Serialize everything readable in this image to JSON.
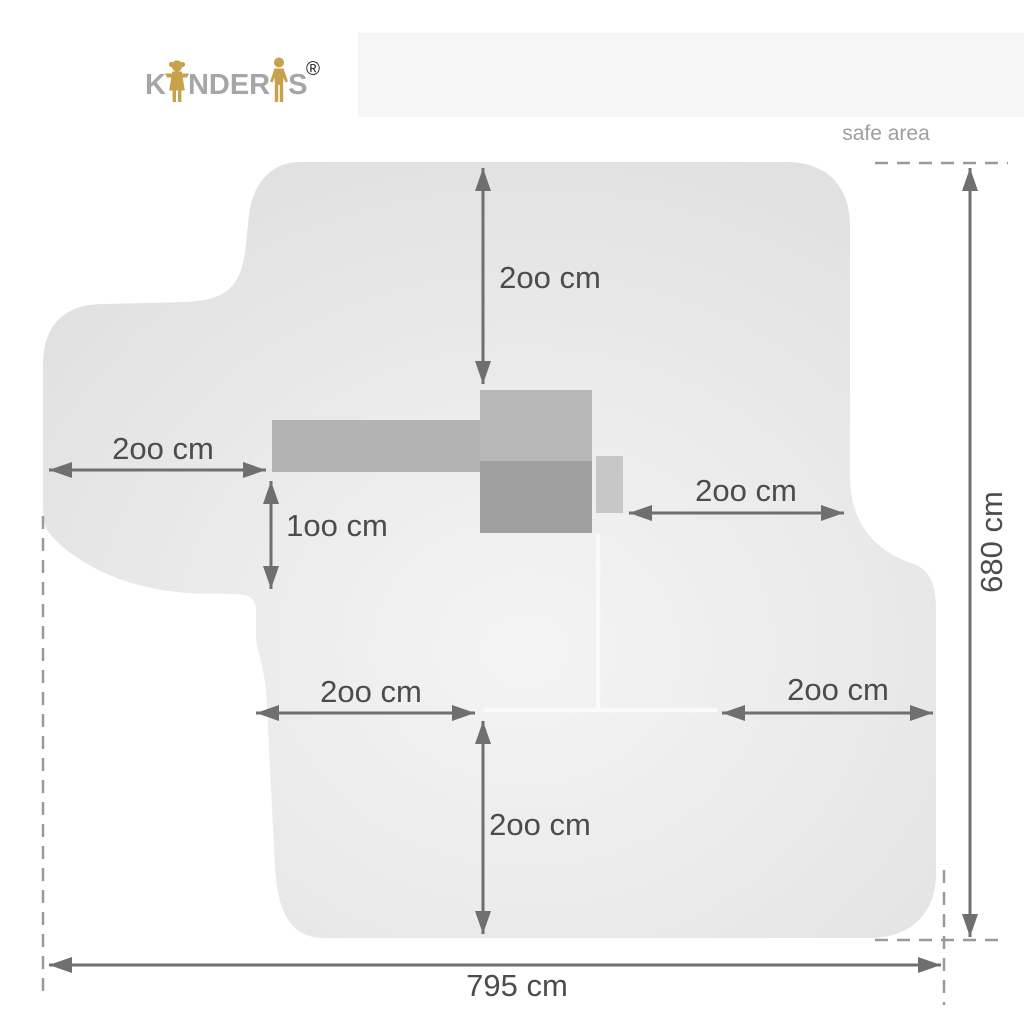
{
  "page": {
    "background_color": "#ffffff",
    "top_band_color": "#f6f6f6"
  },
  "brand": {
    "name": "KINDERIS",
    "letters_start": "K",
    "letters_middle": "NDER",
    "letters_end": "S",
    "registered_mark": "®",
    "letter_color": "#a6a6a6",
    "figure_color": "#c8a24b"
  },
  "diagram": {
    "safe_area_label": "safe area",
    "total_width_label": "795 cm",
    "total_height_label": "680 cm",
    "total_width_cm": 795,
    "total_height_cm": 680,
    "dimensions": [
      {
        "id": "clearance-top",
        "label": "2oo cm",
        "value_cm": 200,
        "orientation": "vertical"
      },
      {
        "id": "clearance-left",
        "label": "2oo cm",
        "value_cm": 200,
        "orientation": "horizontal"
      },
      {
        "id": "clearance-left-drop",
        "label": "1oo cm",
        "value_cm": 100,
        "orientation": "vertical"
      },
      {
        "id": "clearance-right",
        "label": "2oo cm",
        "value_cm": 200,
        "orientation": "horizontal"
      },
      {
        "id": "clearance-bottom-left",
        "label": "2oo cm",
        "value_cm": 200,
        "orientation": "horizontal"
      },
      {
        "id": "clearance-bottom-right",
        "label": "2oo cm",
        "value_cm": 200,
        "orientation": "horizontal"
      },
      {
        "id": "clearance-bottom",
        "label": "2oo cm",
        "value_cm": 200,
        "orientation": "vertical"
      }
    ],
    "colors": {
      "safe_area_fill_center": "#f4f4f4",
      "safe_area_fill_edge": "#e1e1e1",
      "dimension_line": "#6f6f6f",
      "dimension_text": "#4c4c4c",
      "dashed_extension_line": "#9a9a9a",
      "safe_area_label_text": "#9e9e9e",
      "equipment_bar": "#b3b3b3",
      "equipment_upper_block": "#b7b7b7",
      "equipment_lower_block": "#a0a0a0",
      "equipment_side_block": "#c7c7c7",
      "seam_line": "#fafafa"
    }
  }
}
